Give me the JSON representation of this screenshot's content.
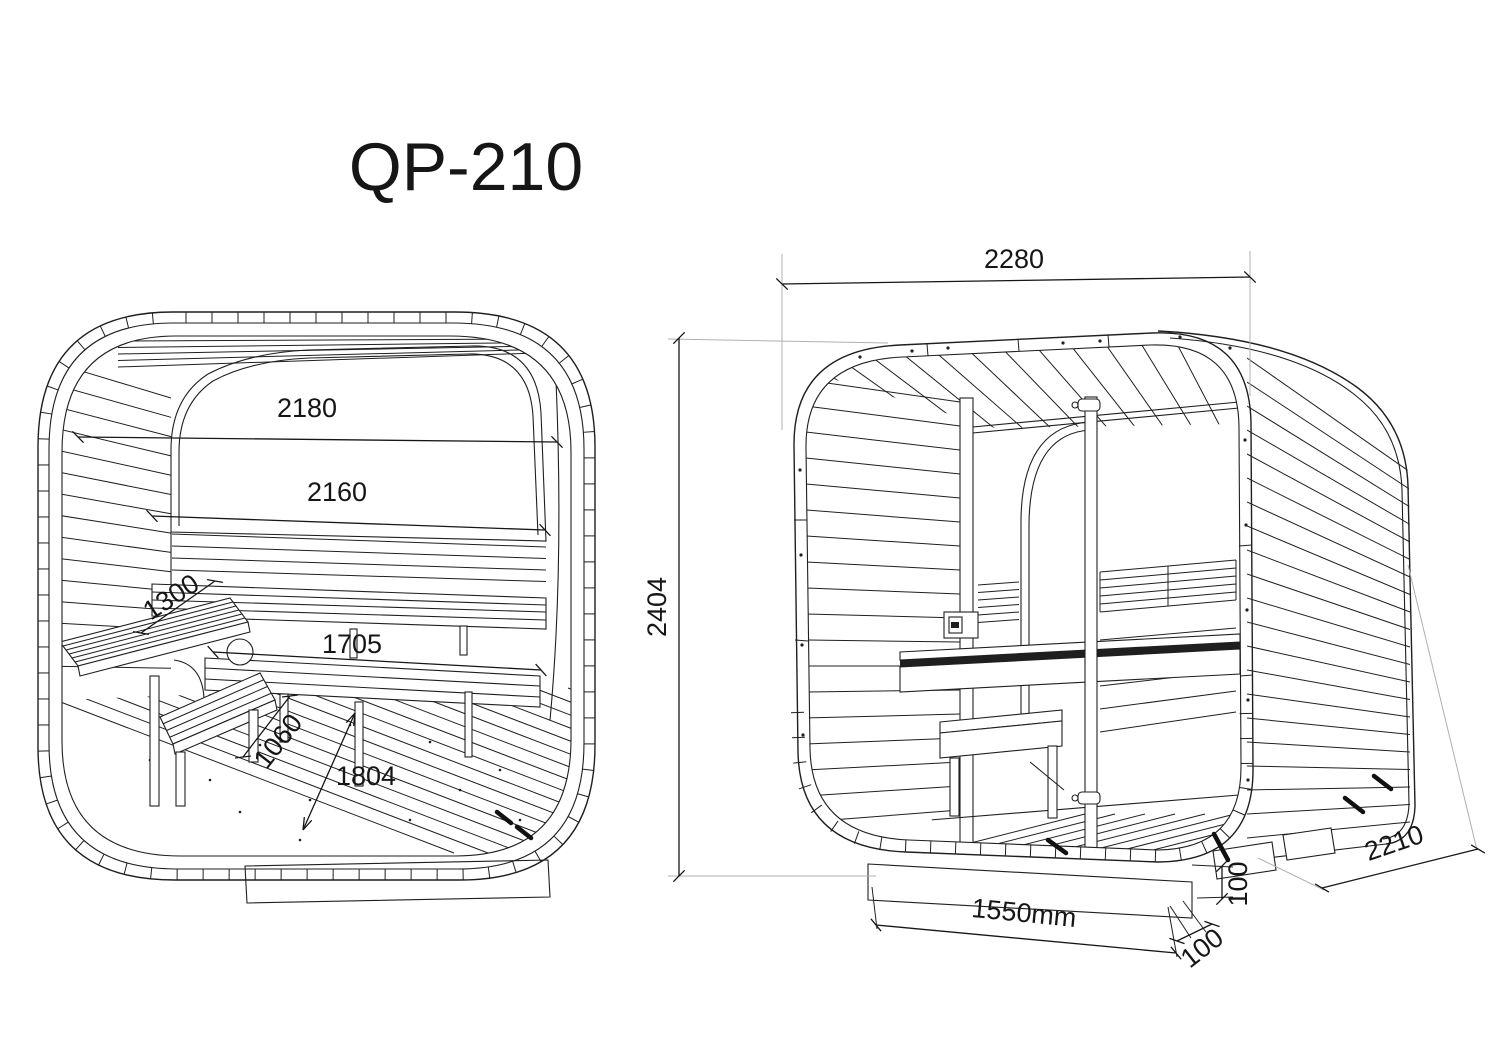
{
  "title": "QP-210",
  "drawing": {
    "type": "technical-dimension-drawing",
    "subject": "cube sauna",
    "colors": {
      "line": "#1f1f1f",
      "light_line": "#b0b0b0",
      "background": "#ffffff",
      "text": "#161616"
    },
    "views": {
      "front_section": {
        "label": "front cross-section view",
        "dims": {
          "inner_width_top": "2180",
          "inner_width_sill": "2160",
          "side_bench_depth": "1300",
          "lower_bench_width": "1705",
          "bench_diagonal": "1060",
          "floor_diagonal": "1804"
        }
      },
      "perspective": {
        "label": "perspective view",
        "dims": {
          "overall_width": "2280",
          "overall_height": "2404",
          "overall_depth": "2210",
          "base_width": "1550mm",
          "base_height": "100",
          "base_inset": "100"
        }
      }
    }
  }
}
